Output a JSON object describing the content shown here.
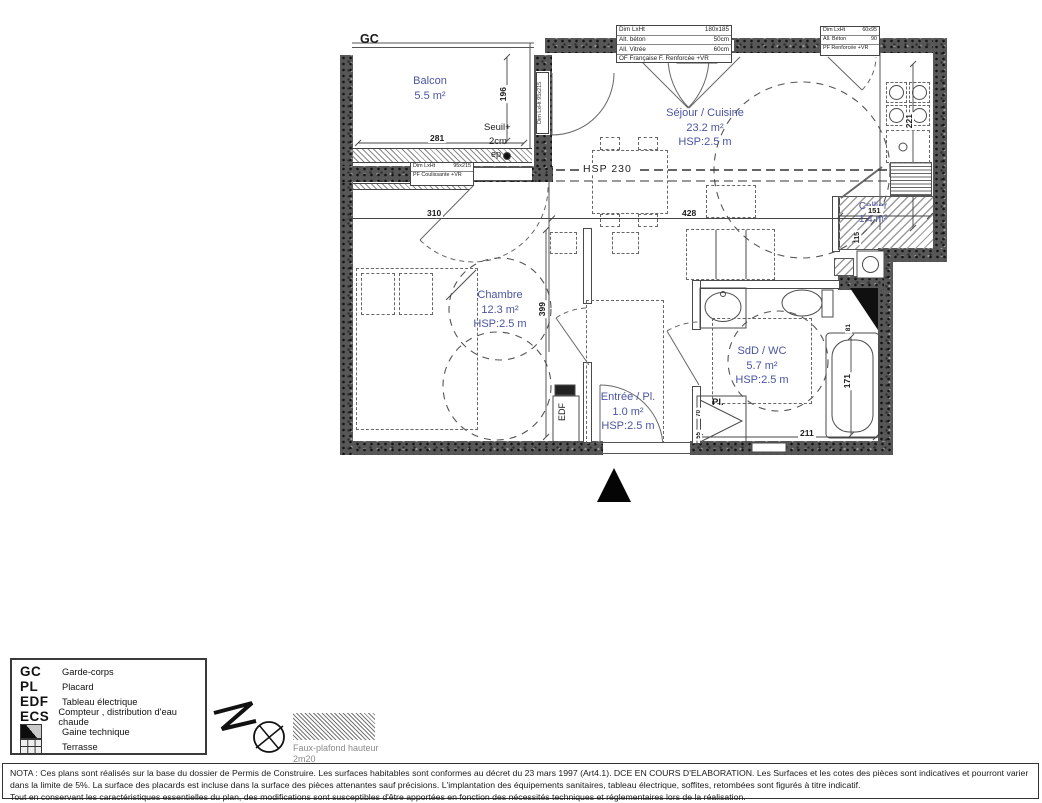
{
  "colors": {
    "room_label": "#4a55a2",
    "wall_dark": "#575757"
  },
  "plan": {
    "gc": "GC",
    "rooms": {
      "balcon": {
        "name": "Balcon",
        "area": "5.5 m²"
      },
      "sejour": {
        "name": "Séjour / Cuisine",
        "area": "23.2 m²",
        "hsp": "HSP:2.5 m"
      },
      "chambre": {
        "name": "Chambre",
        "area": "12.3 m²",
        "hsp": "HSP:2.5 m"
      },
      "entree": {
        "name": "Entrée / Pl.",
        "area": "1.0 m²",
        "hsp": "HSP:2.5 m"
      },
      "sdd": {
        "name": "SdD / WC",
        "area": "5.7 m²",
        "hsp": "HSP:2.5 m"
      },
      "cellier": {
        "name": "Cellier",
        "area": "1.4 m²"
      }
    },
    "ann": {
      "seuil1": "Seuil+",
      "seuil2": "2cm",
      "ep": "ep",
      "hsp230": "HSP 230",
      "edf": "EDF",
      "pl": "Pl."
    },
    "dims": {
      "balcon_w": "281",
      "balcon_h": "196",
      "chambre_w": "310",
      "sejour_w": "428",
      "chambre_h": "399",
      "kitchen_h": "221",
      "cellier_w": "151",
      "cellier_h": "115",
      "bath_h": "171",
      "bath_w": "81",
      "sdd_w": "211",
      "pl_d": "70",
      "pl_w": "55"
    },
    "win_big": [
      [
        "Dim LxHt",
        "180x185"
      ],
      [
        "Alt. béton",
        "50cm"
      ],
      [
        "All. Vitrée",
        "60cm"
      ],
      [
        "OF Française  F. Renforcée +VR"
      ]
    ],
    "win_small": [
      [
        "Dim LxHt",
        "60x95"
      ],
      [
        "All. Béton",
        "90"
      ],
      [
        "PF Renforcée +VR"
      ]
    ],
    "win_chambre": [
      [
        "Dim LxHt",
        "95x215"
      ],
      [
        "PF Coulissante +VR"
      ]
    ],
    "win_balcony_door": "Dim LxHt 95x215"
  },
  "legend": {
    "items": [
      {
        "abbr": "GC",
        "label": "Garde-corps"
      },
      {
        "abbr": "PL",
        "label": "Placard"
      },
      {
        "abbr": "EDF",
        "label": "Tableau électrique"
      },
      {
        "abbr": "ECS",
        "label": "Compteur , distribution d'eau chaude"
      },
      {
        "abbr": "",
        "label": "Gaine technique"
      },
      {
        "abbr": "",
        "label": "Terrasse"
      }
    ]
  },
  "footer": {
    "faux1": "Faux-plafond hauteur",
    "faux2": "2m20"
  },
  "nota": {
    "l1": "NOTA : Ces plans sont réalisés sur la base du dossier de Permis de Construire. Les surfaces habitables sont conformes au décret du 23 mars 1997 (Art4.1). DCE EN COURS D'ELABORATION. Les Surfaces et les cotes des pièces sont indicatives et pourront varier",
    "l2": "dans la limite de 5%. La surface des placards est incluse dans la surface des pièces attenantes sauf précisions. L'implantation des équipements sanitaires, tableau électrique, soffites, retombées sont figurés à titre indicatif.",
    "l3": "Tout en conservant les caractéristiques essentielles du plan, des modifications sont susceptibles d'être apportées en fonction des nécessités techniques et réglementaires lors de la réalisation."
  }
}
